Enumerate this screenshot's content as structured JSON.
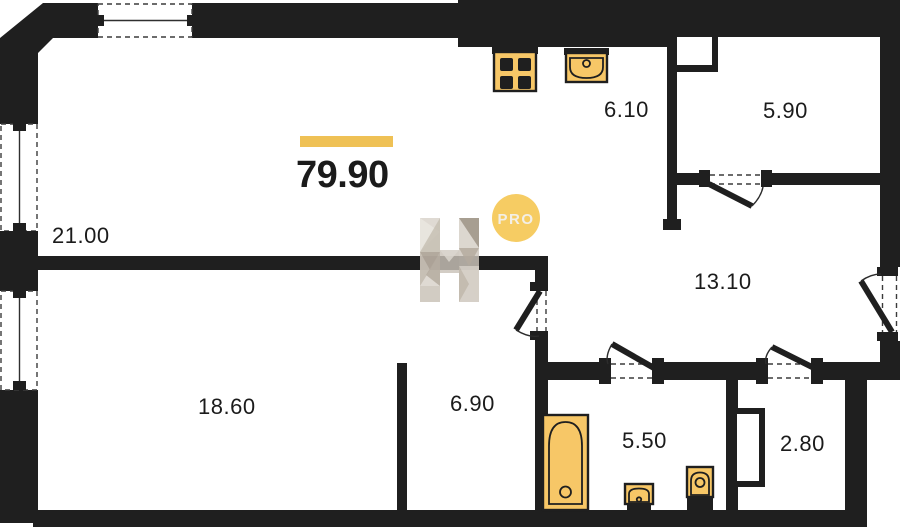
{
  "plan": {
    "total_area": "79.90",
    "badge": "PRO",
    "rooms": {
      "living": "21.00",
      "kitchen": "6.10",
      "pantry": "5.90",
      "hall": "13.10",
      "bedroom": "18.60",
      "alcove": "6.90",
      "bathroom": "5.50",
      "wc": "2.80"
    },
    "colors": {
      "wall": "#1f1f1f",
      "accent_bar": "#efc155",
      "fixture_fill": "#f7c767",
      "badge_bg": "#f6cc63",
      "badge_text": "#f3efe7",
      "label_text": "#1b1b1b",
      "watermark_tones": [
        "#eae6e0",
        "#d8d2c9",
        "#c6beb2",
        "#b3aa9d",
        "#9c9285"
      ]
    }
  }
}
